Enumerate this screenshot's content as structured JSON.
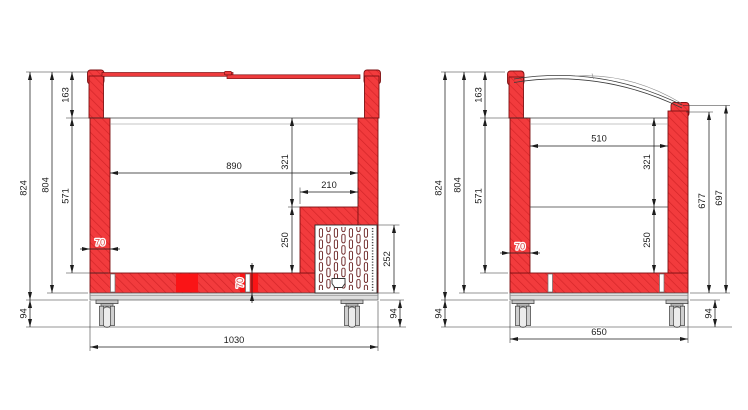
{
  "drawing_type": "freezer cross-section technical drawing",
  "colors": {
    "section_red": "#f23b3d",
    "hatch_red": "#d22427",
    "solid_red_patch": "#fa1416",
    "outline_dark_red": "#7e1113",
    "dimension_black": "#1c1c1c",
    "red_dim_text": "#d8413f",
    "base_gray": "#dedede"
  },
  "front_view": {
    "dims": {
      "overall_height": "824",
      "body_height": "804",
      "lid_height": "163",
      "inner_depth": "571",
      "inner_width": "890",
      "step_upper_depth": "321",
      "step_width": "210",
      "step_lower_depth": "250",
      "vent_panel_height": "252",
      "wall_thickness": "70",
      "floor_thickness": "70",
      "caster_height_left": "94",
      "caster_height_right": "94",
      "overall_width": "1030"
    }
  },
  "side_view": {
    "dims": {
      "overall_height": "824",
      "body_height": "804",
      "lid_height": "163",
      "inner_depth": "571",
      "inner_width": "510",
      "upper_inner_depth": "321",
      "lower_inner_depth": "250",
      "wall_thickness": "70",
      "glass_edge_height": "677",
      "rail_height": "697",
      "caster_height_left": "94",
      "caster_height_right": "94",
      "overall_width": "650"
    }
  }
}
